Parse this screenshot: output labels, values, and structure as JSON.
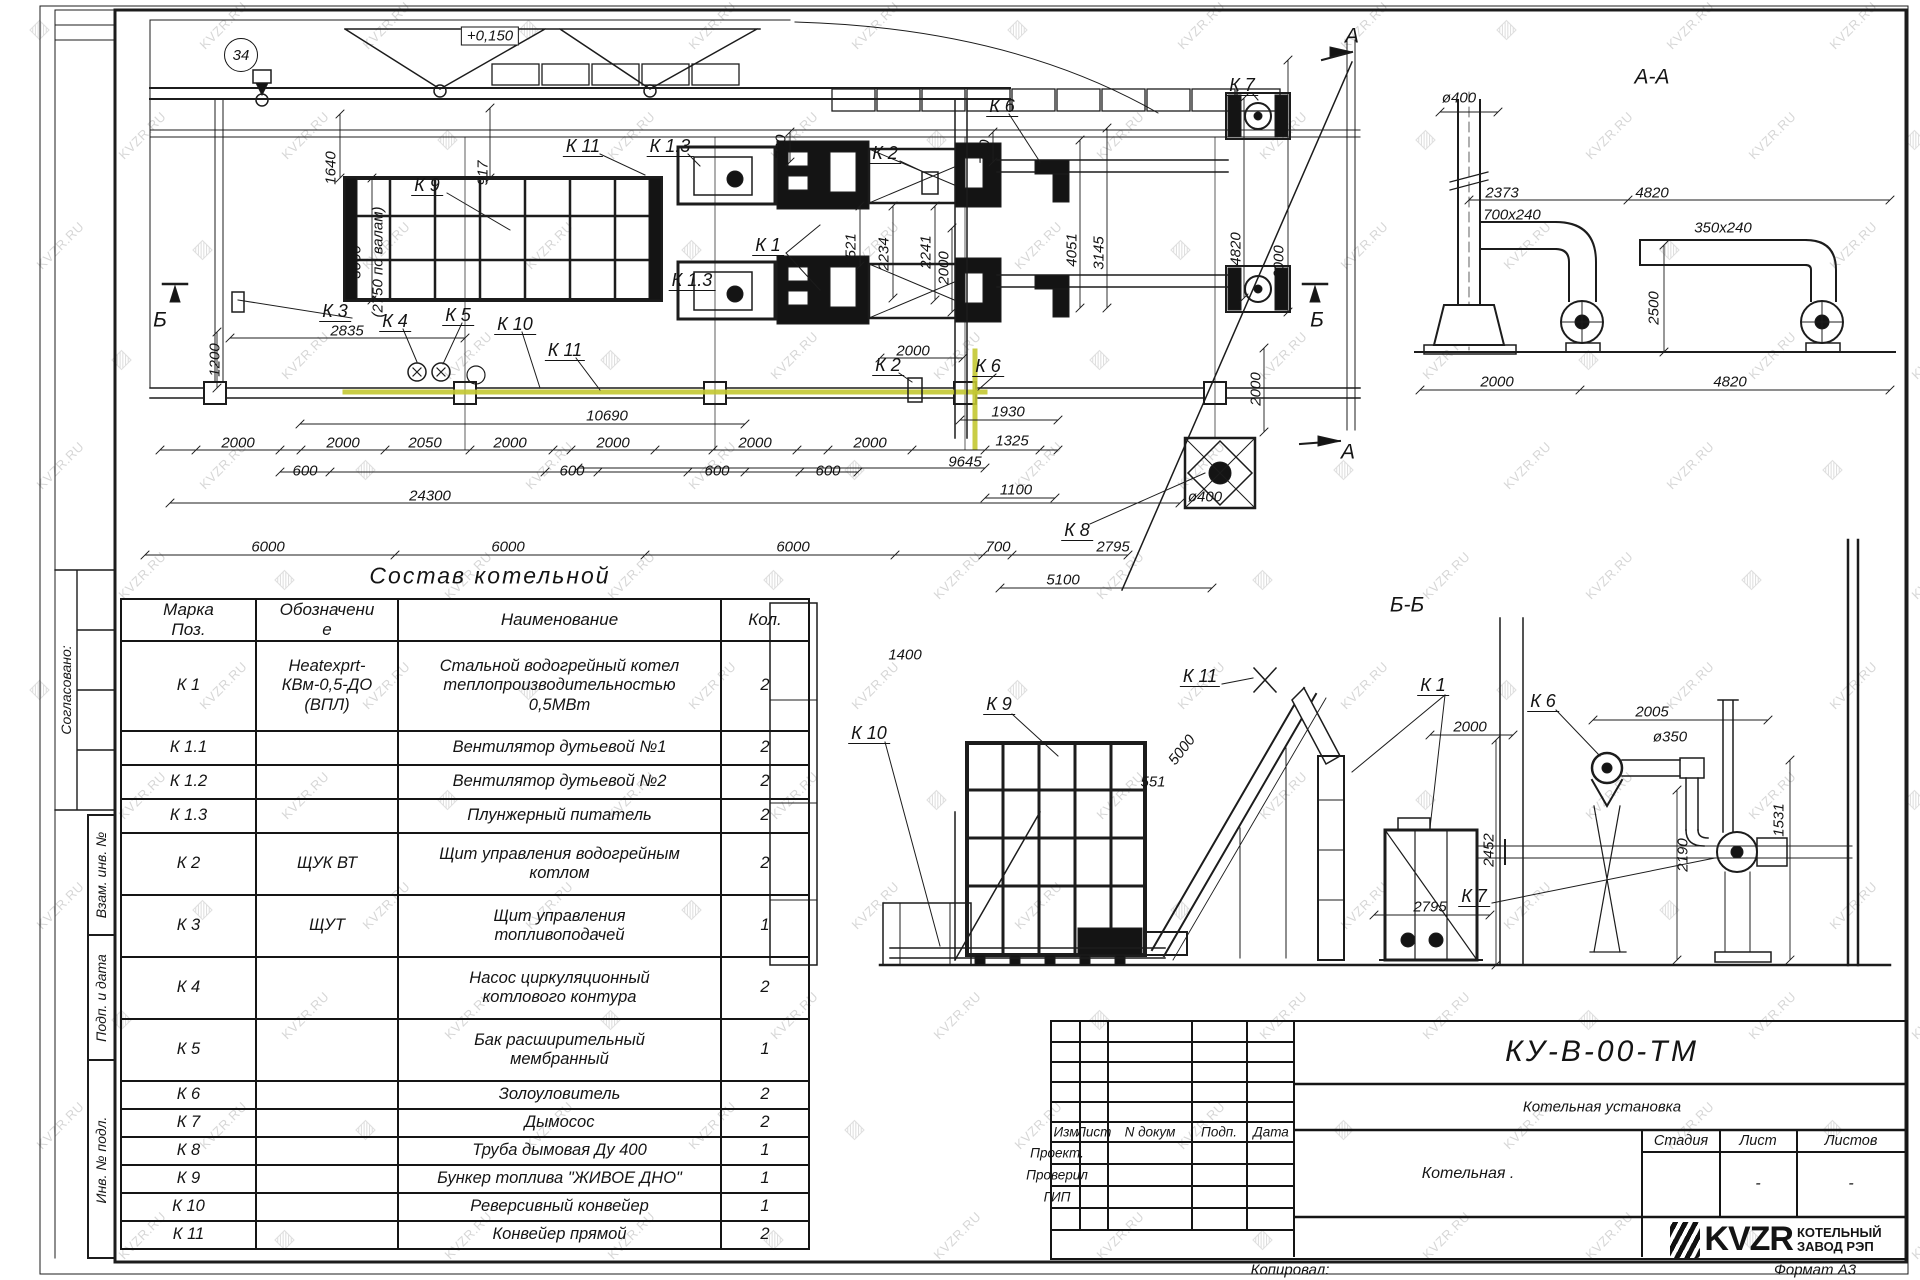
{
  "sheet": {
    "copied_label": "Копировал:",
    "format_label": "Формат А3"
  },
  "margin": {
    "agreed": "Согласовано:",
    "replace_inv": "Взам. инв. №",
    "sign_date": "Подп. и дата",
    "inv_orig": "Инв. № подл."
  },
  "watermark": {
    "text": "KVZR.RU",
    "logo_glyph": "▨"
  },
  "components_table": {
    "title": "Состав котельной",
    "headers": [
      "Марка\nПоз.",
      "Обозначени\nе",
      "Наименование",
      "Кол."
    ],
    "rows": [
      [
        "К 1",
        "Heatexprt-\nКВм-0,5-ДО\n(ВПЛ)",
        "Стальной водогрейный котел\nтеплопроизводительностью\n0,5МВт",
        "2"
      ],
      [
        "К 1.1",
        "",
        "Вентилятор дутьевой №1",
        "2"
      ],
      [
        "К 1.2",
        "",
        "Вентилятор дутьевой №2",
        "2"
      ],
      [
        "К 1.3",
        "",
        "Плунжерный питатель",
        "2"
      ],
      [
        "К 2",
        "ЩУК ВТ",
        "Щит управления водогрейным\nкотлом",
        "2"
      ],
      [
        "К 3",
        "ЩУТ",
        "Щит управления\nтопливоподачей",
        "1"
      ],
      [
        "К 4",
        "",
        "Насос циркуляционный\nкотлового контура",
        "2"
      ],
      [
        "К 5",
        "",
        "Бак расширительный\nмембранный",
        "1"
      ],
      [
        "К 6",
        "",
        "Золоуловитель",
        "2"
      ],
      [
        "К 7",
        "",
        "Дымосос",
        "2"
      ],
      [
        "К 8",
        "",
        "Труба дымовая Ду 400",
        "1"
      ],
      [
        "К 9",
        "",
        "Бункер топлива \"ЖИВОЕ ДНО\"",
        "1"
      ],
      [
        "К 10",
        "",
        "Реверсивный конвейер",
        "1"
      ],
      [
        "К 11",
        "",
        "Конвейер прямой",
        "2"
      ]
    ]
  },
  "title_block": {
    "doc_number": "КУ-В-00-ТМ",
    "doc_title": "Котельная установка",
    "object_name": "Котельная .",
    "columns": [
      "Изм",
      "Лист",
      "N докум",
      "Подп.",
      "Дата"
    ],
    "roles": [
      "Проект.",
      "Проверил",
      "ГИП"
    ],
    "stage_headers": [
      "Стадия",
      "Лист",
      "Листов"
    ],
    "sheet_value": "-",
    "sheets_value": "-",
    "logo_text": "KVZR",
    "logo_caption_line1": "КОТЕЛЬНЫЙ",
    "logo_caption_line2": "ЗАВОД РЭП"
  },
  "annotations": [
    {
      "t": "+0,150",
      "x": 490,
      "y": 36,
      "c": "e"
    },
    {
      "t": "34",
      "x": 241,
      "y": 55,
      "c": "gb"
    },
    {
      "t": "1640",
      "x": 331,
      "y": 168,
      "r": -90,
      "c": "d"
    },
    {
      "t": "917",
      "x": 483,
      "y": 173,
      "r": -90,
      "c": "d"
    },
    {
      "t": "3000",
      "x": 356,
      "y": 262,
      "r": -90,
      "c": "d"
    },
    {
      "t": "(2750 по валам)",
      "x": 378,
      "y": 262,
      "r": -90,
      "c": "d"
    },
    {
      "t": "К 9",
      "x": 427,
      "y": 186,
      "c": "l"
    },
    {
      "t": "К 11",
      "x": 583,
      "y": 147,
      "c": "l"
    },
    {
      "t": "К 1.3",
      "x": 670,
      "y": 147,
      "c": "l"
    },
    {
      "t": "700",
      "x": 781,
      "y": 147,
      "r": -90,
      "c": "d"
    },
    {
      "t": "К 2",
      "x": 885,
      "y": 154,
      "c": "l"
    },
    {
      "t": "700",
      "x": 985,
      "y": 152,
      "r": -90,
      "c": "d"
    },
    {
      "t": "К 6",
      "x": 1002,
      "y": 107,
      "c": "l"
    },
    {
      "t": "К 7",
      "x": 1242,
      "y": 86,
      "c": "l"
    },
    {
      "t": "К 1",
      "x": 768,
      "y": 246,
      "c": "l"
    },
    {
      "t": "К 1.3",
      "x": 692,
      "y": 281,
      "c": "l"
    },
    {
      "t": "1521",
      "x": 851,
      "y": 250,
      "r": -90,
      "c": "d"
    },
    {
      "t": "2234",
      "x": 884,
      "y": 254,
      "r": -90,
      "c": "d"
    },
    {
      "t": "2241",
      "x": 926,
      "y": 252,
      "r": -90,
      "c": "d"
    },
    {
      "t": "2000",
      "x": 944,
      "y": 268,
      "r": -90,
      "c": "d"
    },
    {
      "t": "4051",
      "x": 1072,
      "y": 250,
      "r": -90,
      "c": "d"
    },
    {
      "t": "3145",
      "x": 1099,
      "y": 253,
      "r": -90,
      "c": "d"
    },
    {
      "t": "4820",
      "x": 1236,
      "y": 249,
      "r": -90,
      "c": "d"
    },
    {
      "t": "6000",
      "x": 1279,
      "y": 262,
      "r": -90,
      "c": "d"
    },
    {
      "t": "К 3",
      "x": 335,
      "y": 312,
      "c": "l"
    },
    {
      "t": "2835",
      "x": 347,
      "y": 331,
      "c": "d"
    },
    {
      "t": "К 4",
      "x": 395,
      "y": 322,
      "c": "l"
    },
    {
      "t": "К 5",
      "x": 458,
      "y": 316,
      "c": "l"
    },
    {
      "t": "К 10",
      "x": 515,
      "y": 325,
      "c": "l"
    },
    {
      "t": "К 11",
      "x": 565,
      "y": 351,
      "c": "l"
    },
    {
      "t": "1200",
      "x": 215,
      "y": 360,
      "r": -90,
      "c": "d"
    },
    {
      "t": "Б",
      "x": 160,
      "y": 320,
      "c": "t"
    },
    {
      "t": "Б",
      "x": 1317,
      "y": 320,
      "c": "t"
    },
    {
      "t": "2000",
      "x": 913,
      "y": 351,
      "c": "d"
    },
    {
      "t": "К 2",
      "x": 888,
      "y": 366,
      "c": "l"
    },
    {
      "t": "К 6",
      "x": 988,
      "y": 367,
      "c": "l"
    },
    {
      "t": "2000",
      "x": 1256,
      "y": 389,
      "r": -90,
      "c": "d"
    },
    {
      "t": "1930",
      "x": 1008,
      "y": 412,
      "c": "d"
    },
    {
      "t": "10690",
      "x": 607,
      "y": 416,
      "c": "d"
    },
    {
      "t": "2000",
      "x": 238,
      "y": 443,
      "c": "d"
    },
    {
      "t": "2000",
      "x": 343,
      "y": 443,
      "c": "d"
    },
    {
      "t": "2050",
      "x": 425,
      "y": 443,
      "c": "d"
    },
    {
      "t": "2000",
      "x": 510,
      "y": 443,
      "c": "d"
    },
    {
      "t": "2000",
      "x": 613,
      "y": 443,
      "c": "d"
    },
    {
      "t": "2000",
      "x": 755,
      "y": 443,
      "c": "d"
    },
    {
      "t": "2000",
      "x": 870,
      "y": 443,
      "c": "d"
    },
    {
      "t": "1325",
      "x": 1012,
      "y": 441,
      "c": "d"
    },
    {
      "t": "600",
      "x": 305,
      "y": 471,
      "c": "d"
    },
    {
      "t": "600",
      "x": 572,
      "y": 471,
      "c": "d"
    },
    {
      "t": "600",
      "x": 717,
      "y": 471,
      "c": "d"
    },
    {
      "t": "600",
      "x": 828,
      "y": 471,
      "c": "d"
    },
    {
      "t": "9645",
      "x": 965,
      "y": 462,
      "c": "d"
    },
    {
      "t": "24300",
      "x": 430,
      "y": 496,
      "c": "d"
    },
    {
      "t": "1100",
      "x": 1016,
      "y": 490,
      "c": "d"
    },
    {
      "t": "ø400",
      "x": 1205,
      "y": 497,
      "c": "d"
    },
    {
      "t": "К 8",
      "x": 1077,
      "y": 531,
      "c": "l"
    },
    {
      "t": "6000",
      "x": 268,
      "y": 547,
      "c": "d"
    },
    {
      "t": "6000",
      "x": 508,
      "y": 547,
      "c": "d"
    },
    {
      "t": "6000",
      "x": 793,
      "y": 547,
      "c": "d"
    },
    {
      "t": "700",
      "x": 998,
      "y": 547,
      "c": "d"
    },
    {
      "t": "2795",
      "x": 1113,
      "y": 547,
      "c": "d"
    },
    {
      "t": "5100",
      "x": 1063,
      "y": 580,
      "c": "d"
    },
    {
      "t": "А",
      "x": 1352,
      "y": 36,
      "c": "t"
    },
    {
      "t": "А",
      "x": 1348,
      "y": 452,
      "c": "t"
    },
    {
      "t": "А-А",
      "x": 1652,
      "y": 77,
      "c": "t"
    },
    {
      "t": "ø400",
      "x": 1459,
      "y": 98,
      "c": "d"
    },
    {
      "t": "2373",
      "x": 1502,
      "y": 193,
      "c": "d"
    },
    {
      "t": "4820",
      "x": 1652,
      "y": 193,
      "c": "d"
    },
    {
      "t": "700x240",
      "x": 1512,
      "y": 215,
      "c": "d"
    },
    {
      "t": "350x240",
      "x": 1723,
      "y": 228,
      "c": "d"
    },
    {
      "t": "2500",
      "x": 1654,
      "y": 308,
      "r": -90,
      "c": "d"
    },
    {
      "t": "2000",
      "x": 1497,
      "y": 382,
      "c": "d"
    },
    {
      "t": "4820",
      "x": 1730,
      "y": 382,
      "c": "d"
    },
    {
      "t": "Б-Б",
      "x": 1407,
      "y": 605,
      "c": "t"
    },
    {
      "t": "К 9",
      "x": 999,
      "y": 705,
      "c": "l"
    },
    {
      "t": "К 11",
      "x": 1200,
      "y": 677,
      "c": "l"
    },
    {
      "t": "К 1",
      "x": 1433,
      "y": 686,
      "c": "l"
    },
    {
      "t": "К 6",
      "x": 1543,
      "y": 702,
      "c": "l"
    },
    {
      "t": "К 10",
      "x": 869,
      "y": 734,
      "c": "l"
    },
    {
      "t": "К 7",
      "x": 1474,
      "y": 897,
      "c": "l"
    },
    {
      "t": "5000",
      "x": 1182,
      "y": 750,
      "r": -52,
      "c": "d"
    },
    {
      "t": "551",
      "x": 1153,
      "y": 782,
      "c": "d"
    },
    {
      "t": "1400",
      "x": 905,
      "y": 655,
      "c": "d"
    },
    {
      "t": "2000",
      "x": 1470,
      "y": 727,
      "c": "d"
    },
    {
      "t": "2005",
      "x": 1652,
      "y": 712,
      "c": "d"
    },
    {
      "t": "ø350",
      "x": 1670,
      "y": 737,
      "c": "d"
    },
    {
      "t": "2452",
      "x": 1489,
      "y": 850,
      "r": -90,
      "c": "d"
    },
    {
      "t": "2190",
      "x": 1683,
      "y": 855,
      "r": -90,
      "c": "d"
    },
    {
      "t": "1531",
      "x": 1779,
      "y": 820,
      "r": -90,
      "c": "d"
    },
    {
      "t": "2795",
      "x": 1430,
      "y": 907,
      "c": "d"
    },
    {
      "t": "Состав котельной",
      "x": 490,
      "y": 576,
      "c": "tt"
    }
  ]
}
